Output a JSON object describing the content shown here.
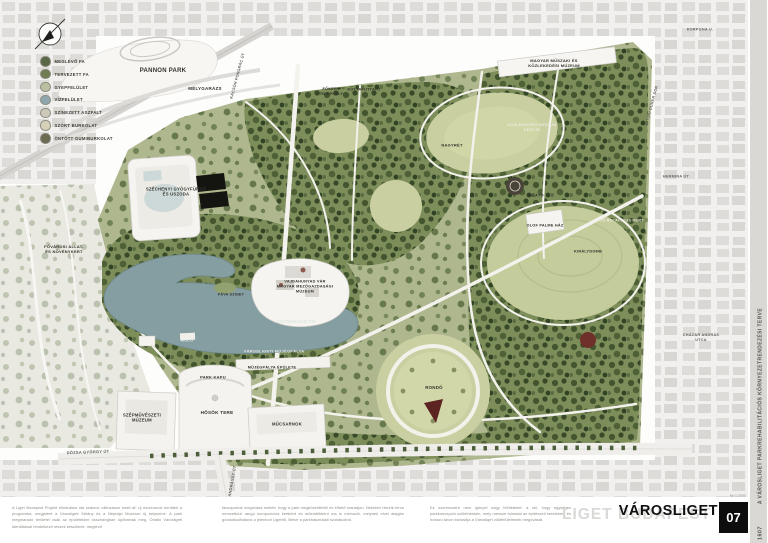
{
  "title_block": {
    "map_title": "VÁROSLIGET",
    "sheet_number": "07",
    "watermark": "LIGET BUDAPEST",
    "side_title": "A VÁROSLIGET PARKREHABILITÁCIÓS KÖRNYEZETRENDEZÉSI TERVE",
    "project_code": "1607",
    "scale": "M=1:2000"
  },
  "legend": {
    "items": [
      {
        "label": "MEGLÉVŐ FA",
        "color": "#5a6847"
      },
      {
        "label": "TERVEZETT FA",
        "color": "#707d52"
      },
      {
        "label": "GYEPFELÜLET",
        "color": "#b9bfa0"
      },
      {
        "label": "VÍZFELÜLET",
        "color": "#8ea7ad"
      },
      {
        "label": "SZÍNEZETT ASZFALT",
        "color": "#ccc9ba"
      },
      {
        "label": "SZÓRT BURKOLAT",
        "color": "#d6d0b8"
      },
      {
        "label": "ÖNTÖTT GUMIBURKOLAT",
        "color": "#6b6b52"
      }
    ]
  },
  "map_labels": [
    {
      "text": "PANNON PARK",
      "x": 163,
      "y": 72,
      "fs": 6
    },
    {
      "text": "MÉLYGARÁZS",
      "x": 205,
      "y": 89,
      "fs": 4.5
    },
    {
      "text": "FŐKERT\nTELEPHELY",
      "x": 331,
      "y": 92,
      "fs": 3.8
    },
    {
      "text": "KUTYAFUTTATÓ",
      "x": 364,
      "y": 90,
      "fs": 3.8
    },
    {
      "text": "SZÉCHENYI GYÓGYFÜRDŐ\nÉS USZODA",
      "x": 176,
      "y": 192,
      "fs": 4.2
    },
    {
      "text": "MAGYAR MŰSZAKI ÉS\nKÖZLEKEDÉSI MÚZEUM",
      "x": 554,
      "y": 63,
      "fs": 4
    },
    {
      "text": "KÖZLEKEDÉSI MÚZEUM\nKERTJE",
      "x": 532,
      "y": 128,
      "fs": 3.8,
      "color": "#eceadf"
    },
    {
      "text": "NAGYRÉT",
      "x": 452,
      "y": 145,
      "fs": 4
    },
    {
      "text": "VAJDAHUNYAD VÁR\nMAGYAR MEZŐGAZDASÁGI\nMÚZEUM",
      "x": 305,
      "y": 287,
      "fs": 3.8
    },
    {
      "text": "CSÓNAKÁZÓ TÓ",
      "x": 296,
      "y": 322,
      "fs": 4.4,
      "color": "#dfe5df"
    },
    {
      "text": "MÓLÓ",
      "x": 187,
      "y": 341,
      "fs": 3.8,
      "color": "#e7ebe5"
    },
    {
      "text": "PÁVA SZIGET",
      "x": 231,
      "y": 295,
      "fs": 3.6
    },
    {
      "text": "VÁROSLIGETI MŰJÉGPÁLYA",
      "x": 274,
      "y": 351,
      "fs": 4,
      "color": "#e3e8e3"
    },
    {
      "text": "MŰJÉGPÁLYA ÉPÜLETE",
      "x": 272,
      "y": 368,
      "fs": 3.8
    },
    {
      "text": "PARK KAPU",
      "x": 213,
      "y": 377,
      "fs": 4
    },
    {
      "text": "HŐSÖK TERE",
      "x": 217,
      "y": 413,
      "fs": 4.6
    },
    {
      "text": "SZÉPMŰVÉSZETI\nMÚZEUM",
      "x": 142,
      "y": 418,
      "fs": 4.2
    },
    {
      "text": "MŰCSARNOK",
      "x": 287,
      "y": 424,
      "fs": 4.2
    },
    {
      "text": "RONDÓ",
      "x": 434,
      "y": 388,
      "fs": 4.4
    },
    {
      "text": "KILÁTÓ",
      "x": 536,
      "y": 196,
      "fs": 3.8
    },
    {
      "text": "OLOF PALME HÁZ",
      "x": 545,
      "y": 226,
      "fs": 3.8
    },
    {
      "text": "KIS BOTANIKUS KERT",
      "x": 621,
      "y": 221,
      "fs": 3.8,
      "color": "#eceadf"
    },
    {
      "text": "KIRÁLYDOMB",
      "x": 588,
      "y": 252,
      "fs": 3.8
    },
    {
      "text": "FŐVÁROSI ÁLLAT-\nÉS NÖVÉNYKERT",
      "x": 64,
      "y": 249,
      "fs": 4
    }
  ],
  "street_labels": [
    {
      "text": "KACSÓH PONGRÁC ÚT",
      "x": 238,
      "y": 76,
      "rot": -75,
      "fs": 3.8
    },
    {
      "text": "KORPONA U.",
      "x": 700,
      "y": 30,
      "fs": 3.8
    },
    {
      "text": "AJTÓSI DÜRER SOR",
      "x": 652,
      "y": 106,
      "rot": -75,
      "fs": 3.8
    },
    {
      "text": "HERMINA ÚT",
      "x": 676,
      "y": 177,
      "fs": 3.8
    },
    {
      "text": "CHÁZÁR ANDRÁS\nUTCA",
      "x": 701,
      "y": 338,
      "fs": 3.8
    },
    {
      "text": "DÓZSA GYÖRGY ÚT",
      "x": 88,
      "y": 452,
      "rot": -2,
      "fs": 4
    },
    {
      "text": "ANDRÁSSY ÚT",
      "x": 232,
      "y": 481,
      "rot": -80,
      "fs": 4
    }
  ],
  "footer": {
    "columns": [
      {
        "text": "A Liget Budapest Projekt elindulása óta számos változáson esett át: új múzeumok kerültek a programba, megjelent a Városligeti Sétány és a Néprajzi Múzeum új helyszíne. A park megmaradó területei csak az épületekkel összhangban újulhatnak meg. Önálló Városligeti identitással rendelkező részek készülnek, meglévő"
      },
      {
        "text": "facsoportok megóvása mellett, hogy a park megközelíthető és élhető maradjon. Nebbien Henrik terve nemzetközi rangú kompozíciós kertként és műemlékként ma is mérvadó, melynek elvei alapján gondolkodhatunk a jelenkori Ligetről, illetve a parkhasználati szokásokról."
      },
      {
        "text": "Ez szerencsére nem igényel nagy felületeket: a cél, hogy egységes parkkoncepció születhessen, mely messze túlmutat az építészeti kereteken, és hosszú távon biztosítja a Városliget zöldfelületeinek megóvását."
      }
    ]
  }
}
